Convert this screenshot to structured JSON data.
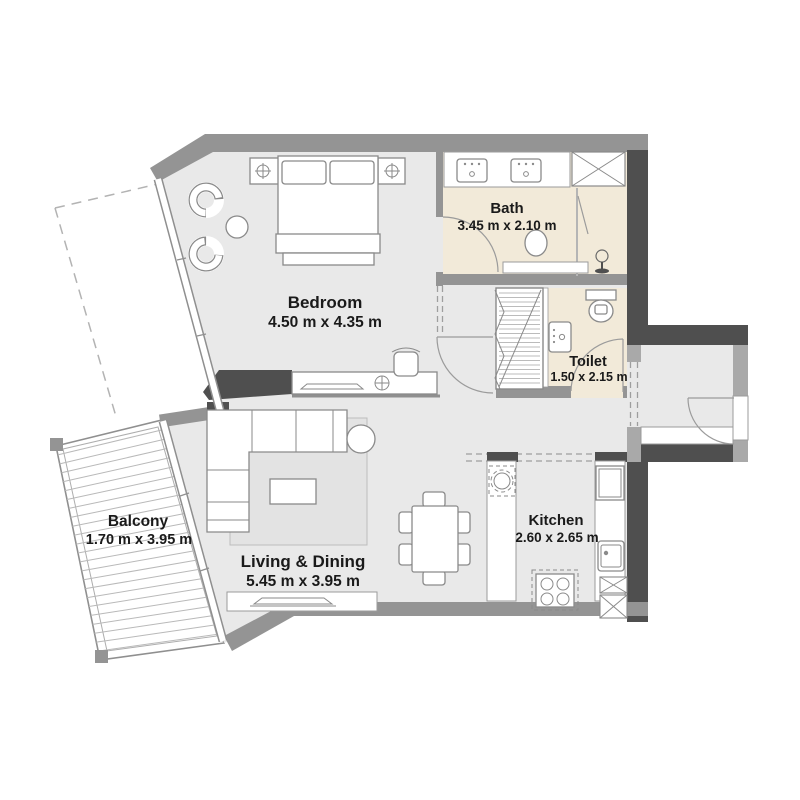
{
  "plan_type": "apartment-floor-plan",
  "rooms": {
    "bedroom": {
      "name": "Bedroom",
      "dims": "4.50 m x 4.35 m"
    },
    "bath": {
      "name": "Bath",
      "dims": "3.45 m x 2.10 m"
    },
    "toilet": {
      "name": "Toilet",
      "dims": "1.50 x 2.15 m"
    },
    "kitchen": {
      "name": "Kitchen",
      "dims": "2.60 x 2.65 m"
    },
    "living": {
      "name": "Living & Dining",
      "dims": "5.45 m x 3.95 m"
    },
    "balcony": {
      "name": "Balcony",
      "dims": "1.70 m x 3.95 m"
    }
  },
  "colors": {
    "wall_dark": "#4f4f4f",
    "wall_medium": "#949494",
    "wall_light": "#a9a9a9",
    "floor": "#e9e9e9",
    "floor_wet": "#f2ead9",
    "furniture_stroke": "#8a8a8a",
    "text": "#1a1a1a",
    "balcony_stripe": "#b9b9b9"
  }
}
